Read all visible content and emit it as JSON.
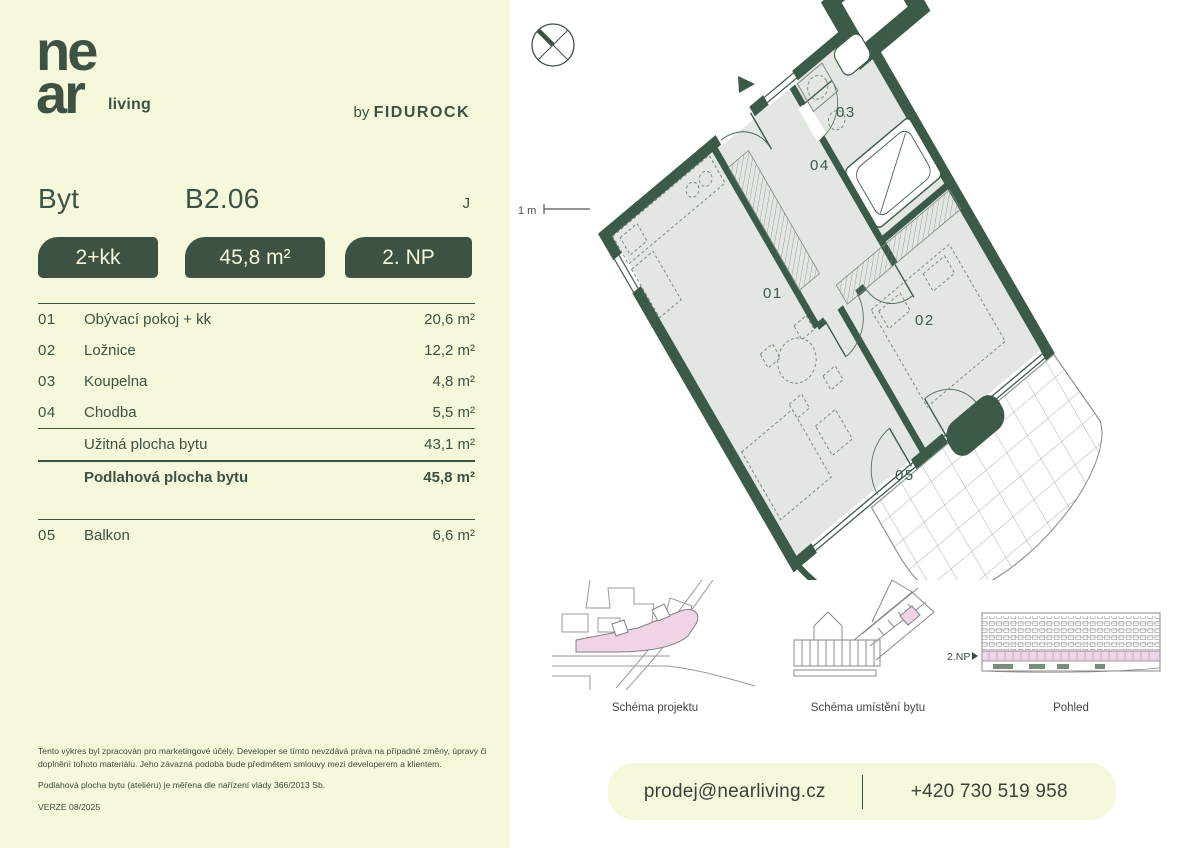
{
  "brand": {
    "logo_line1": "ne",
    "logo_line2": "ar",
    "logo_suffix": "living",
    "byline_prefix": "by",
    "byline_brand": "FIDUROCK"
  },
  "header": {
    "type_label": "Byt",
    "unit_id": "B2.06",
    "building": "J"
  },
  "badges": [
    {
      "label": "2+kk"
    },
    {
      "label": "45,8 m²"
    },
    {
      "label": "2. NP"
    }
  ],
  "rooms": [
    {
      "num": "01",
      "name": "Obývací pokoj + kk",
      "area": "20,6 m²"
    },
    {
      "num": "02",
      "name": "Ložnice",
      "area": "12,2 m²"
    },
    {
      "num": "03",
      "name": "Koupelna",
      "area": "4,8 m²"
    },
    {
      "num": "04",
      "name": "Chodba",
      "area": "5,5 m²"
    }
  ],
  "totals": [
    {
      "name": "Užitná plocha bytu",
      "area": "43,1 m²"
    },
    {
      "name": "Podlahová plocha bytu",
      "area": "45,8 m²"
    }
  ],
  "extra_room": {
    "num": "05",
    "name": "Balkon",
    "area": "6,6 m²"
  },
  "disclaimer": {
    "p1": "Tento výkres byl zpracován pro marketingové účely. Developer se tímto nevzdává práva na případné změny, úpravy či doplnění tohoto materiálu. Jeho závazná podoba bude předmětem smlouvy mezi developerem a klientem.",
    "p2": "Podlahová plocha bytu (ateliéru) je měřena dle nařízení vlády 366/2013 Sb.",
    "version": "VERZE 08/2025"
  },
  "plan": {
    "scale_label": "1 m",
    "room_labels": [
      "01",
      "02",
      "03",
      "04",
      "05"
    ]
  },
  "schematics": [
    {
      "caption": "Schéma projektu"
    },
    {
      "caption": "Schéma umístění bytu"
    },
    {
      "caption": "Pohled",
      "floor_label": "2.NP"
    }
  ],
  "contact": {
    "email": "prodej@nearliving.cz",
    "phone": "+420 730 519 958"
  },
  "colors": {
    "green": "#3d5243",
    "wall_green": "#3b5a47",
    "cream": "#f5f8da",
    "floor": "#e2e7e1",
    "pink": "#f0d4e6"
  }
}
